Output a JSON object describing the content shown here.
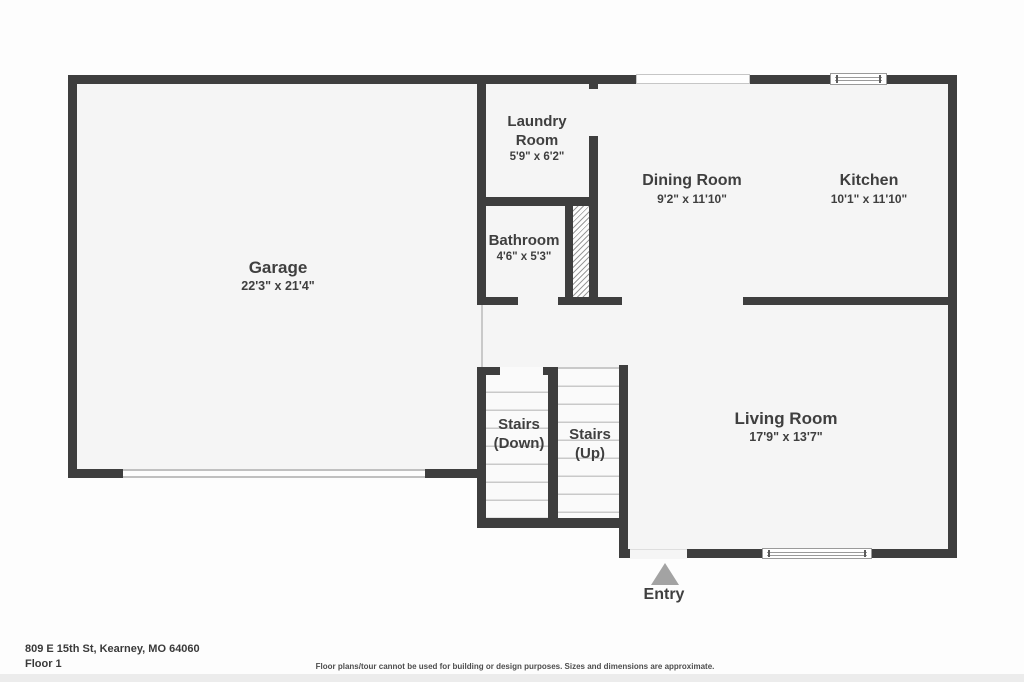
{
  "floor_plan": {
    "rooms": {
      "garage": {
        "name": "Garage",
        "dims": "22'3\" x 21'4\""
      },
      "laundry": {
        "name_line1": "Laundry",
        "name_line2": "Room",
        "dims": "5'9\" x 6'2\""
      },
      "bathroom": {
        "name": "Bathroom",
        "dims": "4'6\" x 5'3\""
      },
      "dining": {
        "name": "Dining Room",
        "dims": "9'2\" x 11'10\""
      },
      "kitchen": {
        "name": "Kitchen",
        "dims": "10'1\" x 11'10\""
      },
      "living": {
        "name": "Living Room",
        "dims": "17'9\" x 13'7\""
      },
      "stairs_down": {
        "name_line1": "Stairs",
        "name_line2": "(Down)"
      },
      "stairs_up": {
        "name_line1": "Stairs",
        "name_line2": "(Up)"
      },
      "entry": {
        "label": "Entry"
      }
    },
    "colors": {
      "wall": "#3e3e3e",
      "room_fill": "#f5f5f5",
      "label_text": "#3f3f3f",
      "step_line": "#c9c9c9",
      "entry_arrow": "#a3a3a3"
    }
  },
  "footer": {
    "address": "809 E 15th St, Kearney, MO 64060",
    "floor_label": "Floor 1",
    "disclaimer": "Floor plans/tour cannot be used for building or design purposes. Sizes and dimensions are approximate."
  }
}
